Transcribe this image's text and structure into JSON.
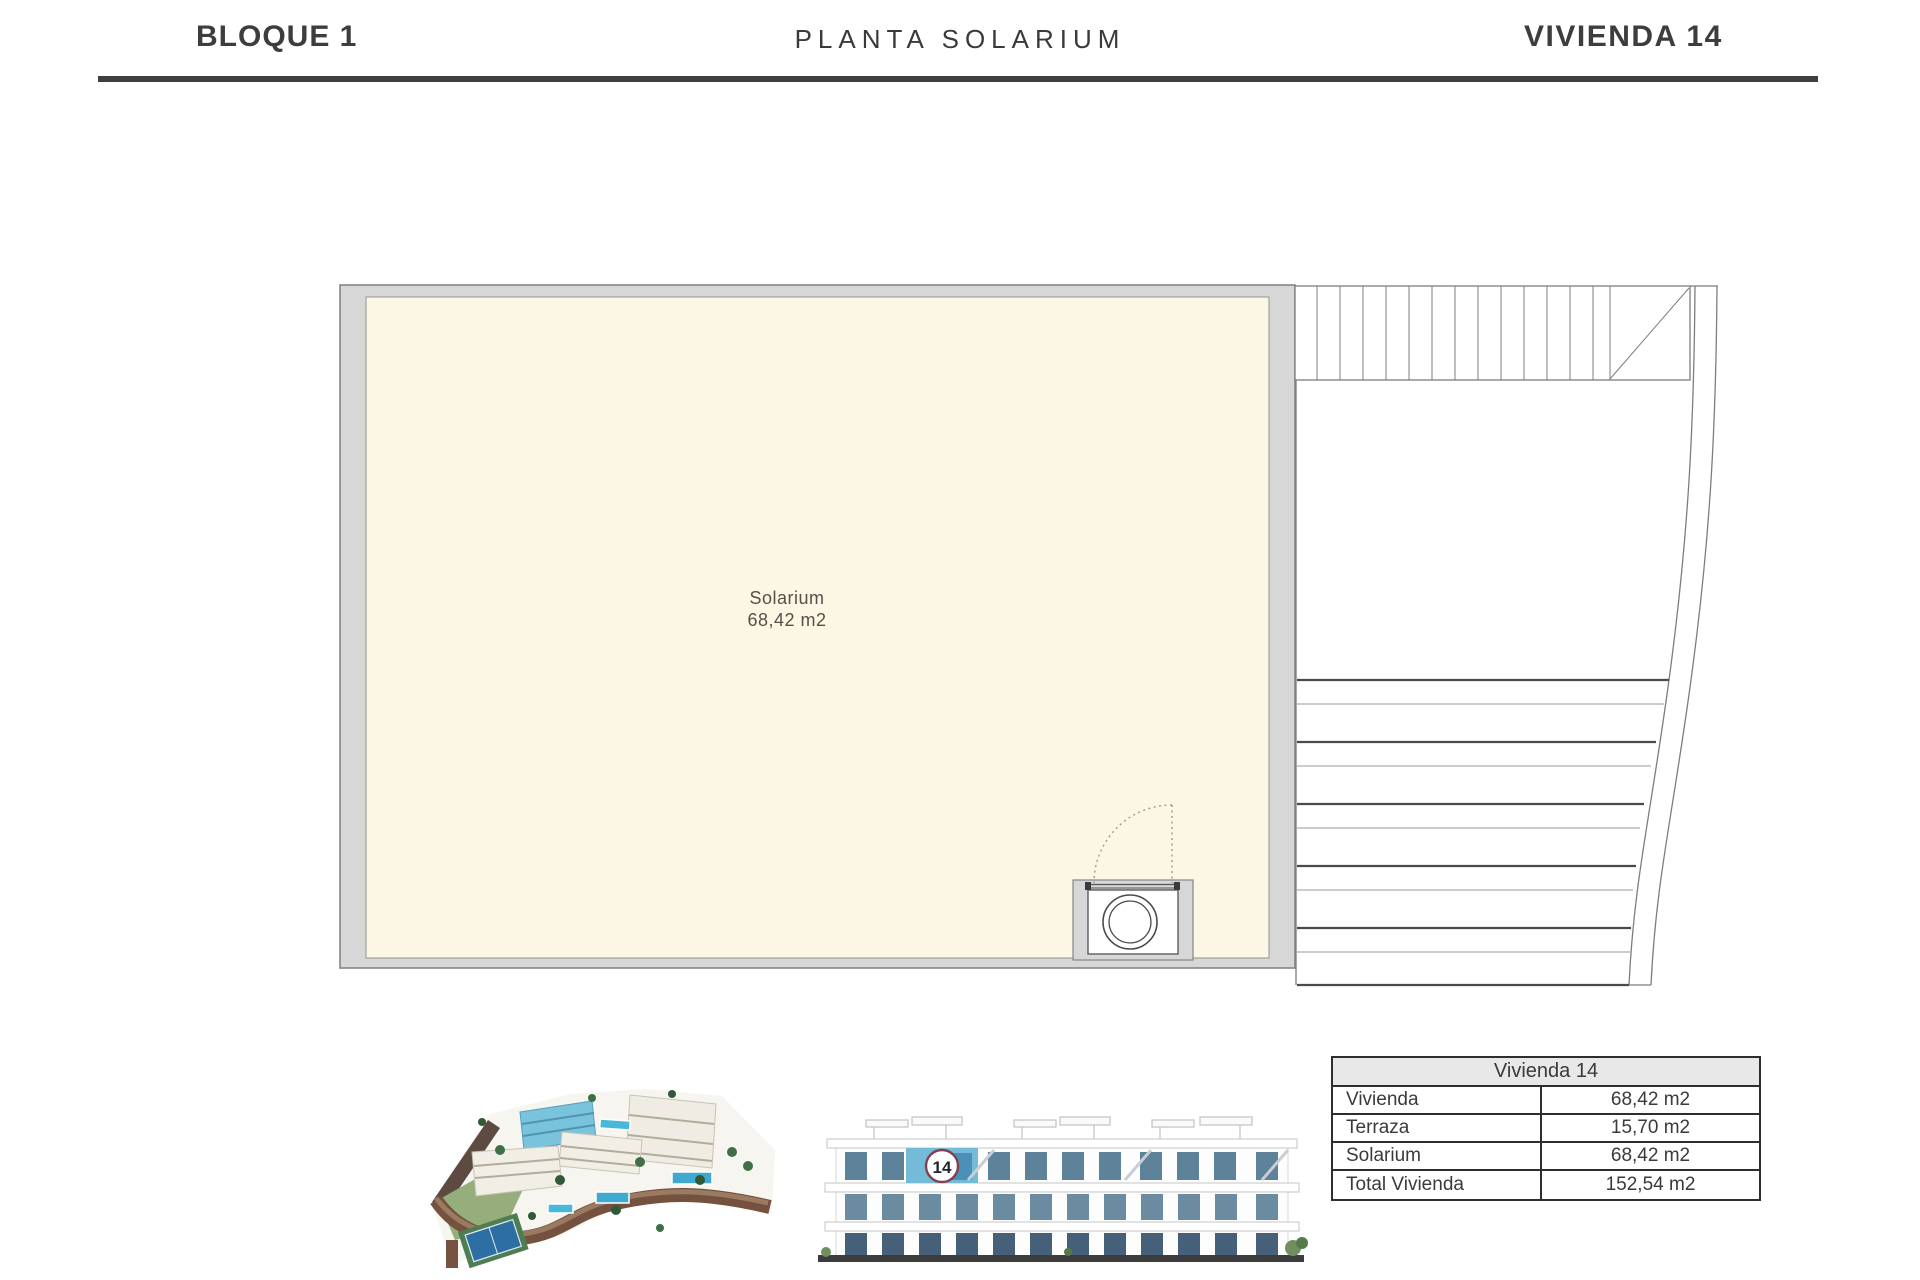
{
  "header": {
    "left_title": "BLOQUE 1",
    "center_title": "PLANTA SOLARIUM",
    "right_title": "VIVIENDA 14"
  },
  "floorplan": {
    "room_label": "Solarium",
    "room_area": "68,42 m2"
  },
  "elevation": {
    "unit_badge": "14"
  },
  "summary_table": {
    "title": "Vivienda 14",
    "rows": [
      {
        "label": "Vivienda",
        "value": "68,42 m2"
      },
      {
        "label": "Terraza",
        "value": "15,70 m2"
      },
      {
        "label": "Solarium",
        "value": "68,42 m2"
      },
      {
        "label": "Total Vivienda",
        "value": "152,54 m2"
      }
    ]
  },
  "colors": {
    "rule_dark": "#3f3f3f",
    "wall_gray": "#d7d7d7",
    "room_cream": "#fcf6e4",
    "highlight_blue": "#74bbd9",
    "badge_ring": "#81404a",
    "table_header_bg": "#e8e8e8"
  }
}
